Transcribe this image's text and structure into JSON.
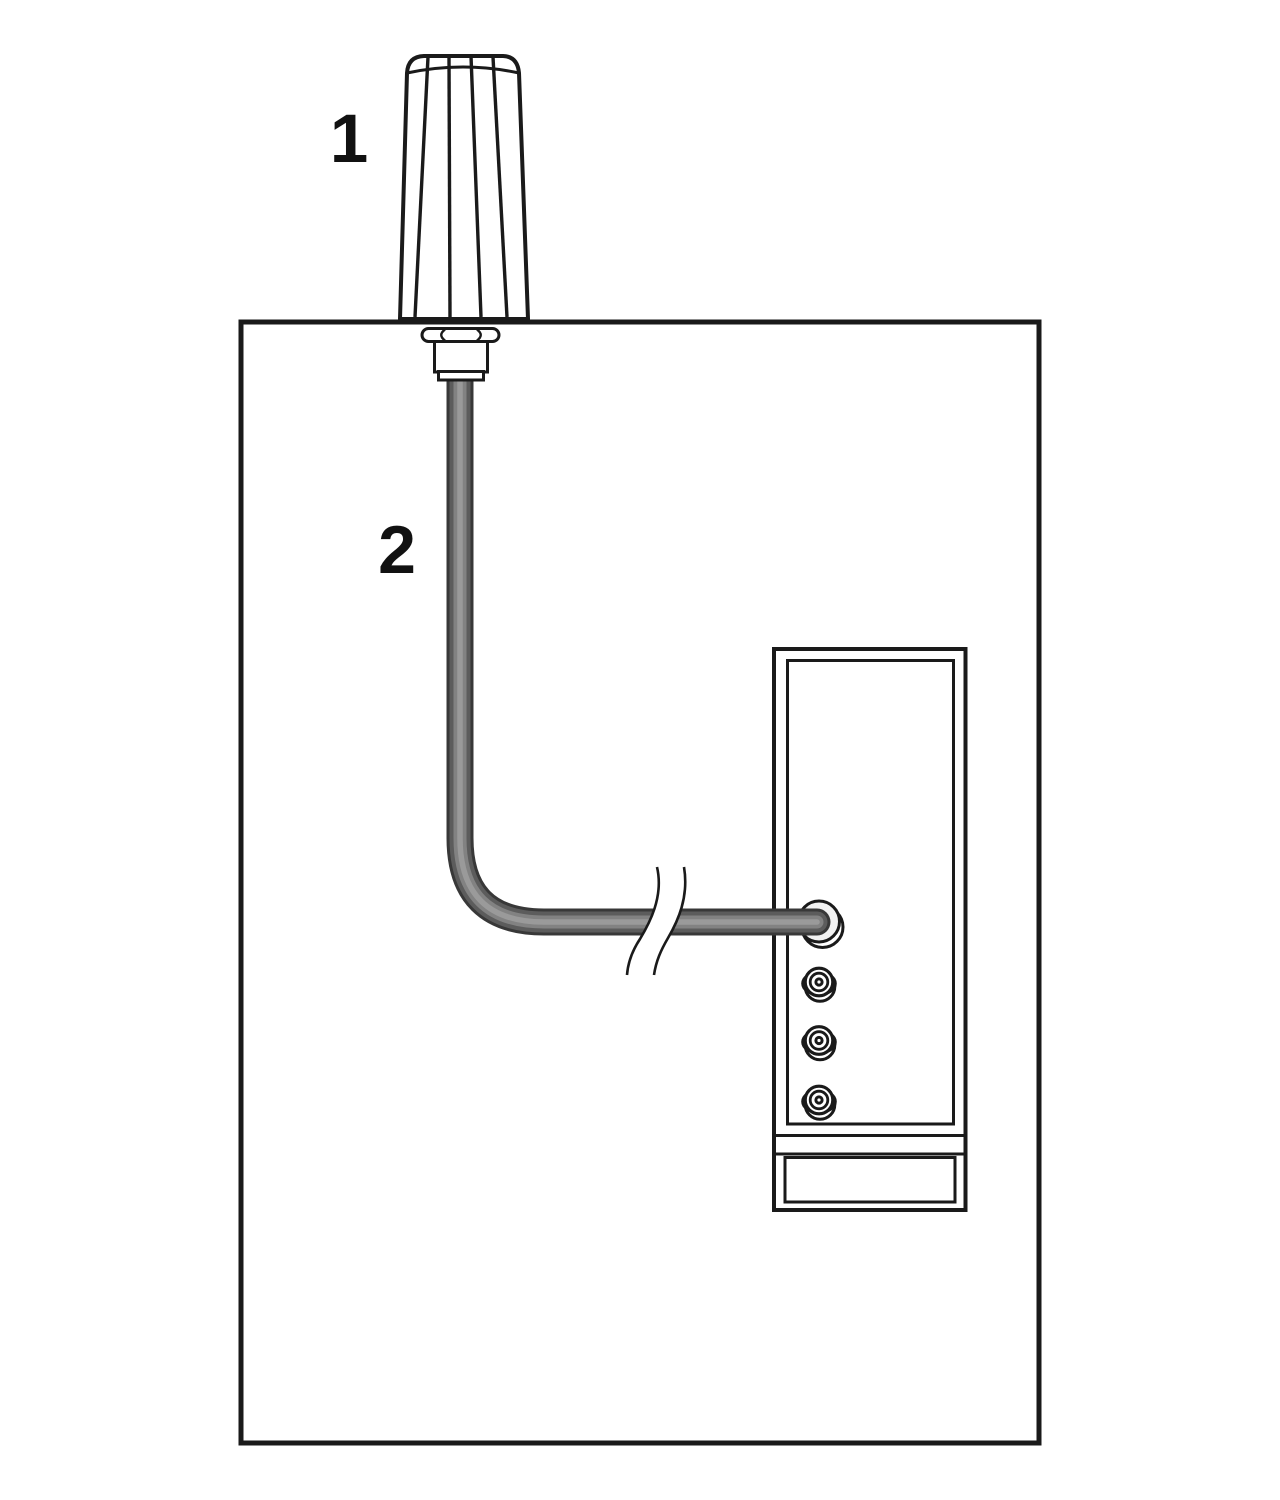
{
  "diagram": {
    "kind": "antenna-installation-illustration",
    "background_color": "#ffffff",
    "line_color": "#1a1a1a",
    "cable_colors": {
      "edge": "#383838",
      "mid": "#5c5c5c",
      "body": "#828282",
      "highlight": "#9a9a9a"
    },
    "port_fill_color": "#f1f1f1"
  },
  "callouts": [
    {
      "label": "1",
      "target": "antenna"
    },
    {
      "label": "2",
      "target": "antenna-cable"
    }
  ]
}
